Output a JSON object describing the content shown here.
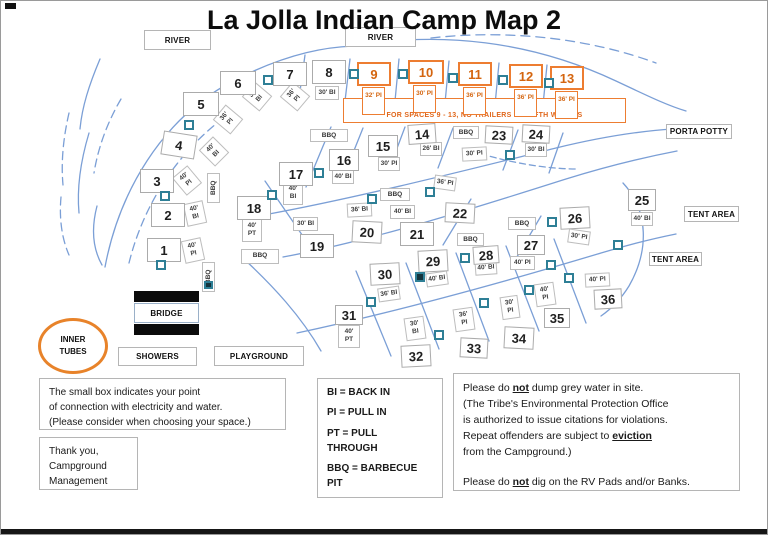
{
  "title": "La Jolla Indian Camp Map 2",
  "river_label": "RIVER",
  "orange_note": "FOR SPACES 9 -  13, NO TRAILERS OR FIFTH WHEELS",
  "bbq_label": "BBQ",
  "colors": {
    "accent_orange": "#ED7D31",
    "connection_teal": "#2E7F96",
    "river_blue": "#7B9FD6"
  },
  "facilities": {
    "porta_potty": "PORTA POTTY",
    "tent_area": "TENT AREA",
    "bridge": "BRIDGE",
    "showers": "SHOWERS",
    "playground": "PLAYGROUND",
    "inner_tubes_line1": "INNER",
    "inner_tubes_line2": "TUBES"
  },
  "sites": [
    {
      "number": "1",
      "size": "40' PI"
    },
    {
      "number": "2",
      "size": "40' BI"
    },
    {
      "number": "3",
      "size": "40' PI"
    },
    {
      "number": "4",
      "size": "40' BI"
    },
    {
      "number": "5",
      "size": "36' PI"
    },
    {
      "number": "6",
      "size": "36' BI"
    },
    {
      "number": "7",
      "size": "36' PI"
    },
    {
      "number": "8",
      "size": "30' BI"
    },
    {
      "number": "9",
      "size": "32' PI"
    },
    {
      "number": "10",
      "size": "30' PI"
    },
    {
      "number": "11",
      "size": "36' PI"
    },
    {
      "number": "12",
      "size": "36' PI"
    },
    {
      "number": "13",
      "size": "36' PI"
    },
    {
      "number": "14",
      "size": "26' BI"
    },
    {
      "number": "15",
      "size": "30' PI"
    },
    {
      "number": "16",
      "size": "40' BI"
    },
    {
      "number": "17",
      "size": "40' BI"
    },
    {
      "number": "18",
      "size": "40' PT"
    },
    {
      "number": "19",
      "size": "30' BI"
    },
    {
      "number": "20",
      "size": "36' BI"
    },
    {
      "number": "21",
      "size": "40' BI"
    },
    {
      "number": "22",
      "size": "36' PI"
    },
    {
      "number": "23",
      "size": "30' PI"
    },
    {
      "number": "24",
      "size": "30' BI"
    },
    {
      "number": "25",
      "size": "40' BI"
    },
    {
      "number": "26",
      "size": "30' PI"
    },
    {
      "number": "27",
      "size": "40' PI"
    },
    {
      "number": "28",
      "size": "40' BI"
    },
    {
      "number": "29",
      "size": "40' BI"
    },
    {
      "number": "30",
      "size": "36' BI"
    },
    {
      "number": "31",
      "size": "40' PT"
    },
    {
      "number": "32",
      "size": "30' BI"
    },
    {
      "number": "33",
      "size": "36' PI"
    },
    {
      "number": "34",
      "size": "30' PI"
    },
    {
      "number": "35",
      "size": "40' PI"
    },
    {
      "number": "36",
      "size": "40' PI"
    }
  ],
  "legend": {
    "bi": "BI = BACK IN",
    "pi": "PI = PULL IN",
    "pt": "PT = PULL\nTHROUGH",
    "bbq": "BBQ = BARBECUE PIT"
  },
  "connection_note": {
    "line1": "The small box indicates your point",
    "line2": "of connection with electricity and water.",
    "line3": "(Please consider when choosing your space.)"
  },
  "thanks": {
    "line1": "Thank you,",
    "line2": "Campground",
    "line3": "Management"
  },
  "rules": {
    "l1a": "Please do ",
    "l1b": "not",
    "l1c": " dump grey water in site.",
    "l2": "(The Tribe's Environmental Protection Office",
    "l3": "is authorized to issue citations for violations.",
    "l4a": "Repeat offenders are subject to ",
    "l4b": "eviction",
    "l5": "from the Campground.)",
    "l6a": "Please do ",
    "l6b": "not",
    "l6c": " dig on the RV Pads and/or Banks."
  }
}
